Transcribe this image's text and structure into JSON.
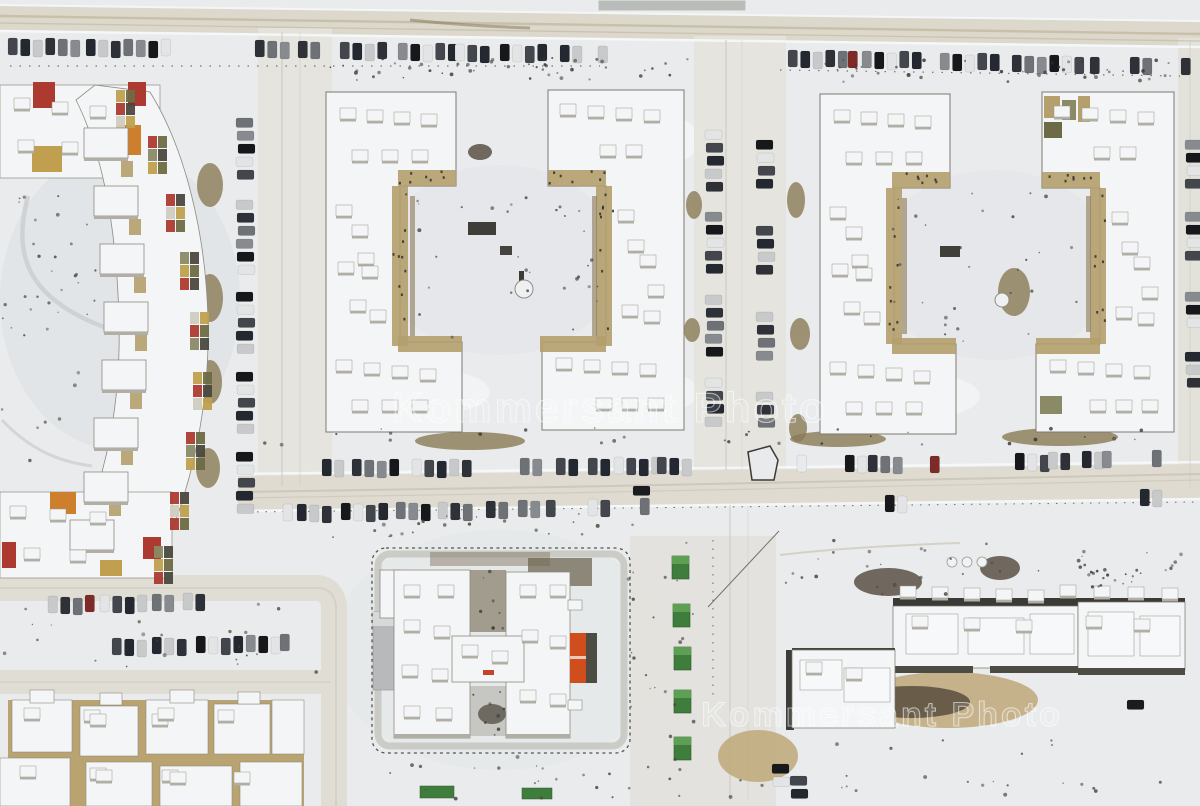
{
  "image": {
    "description": "Aerial winter drone photo of a snow-covered residential district: colorful zigzag apartment block on the left, four C-shaped apartment buildings around two courtyards, an H-shaped school under construction, a long building site at bottom right, parking rows full of cars along the streets",
    "width": 1200,
    "height": 806
  },
  "watermarks": {
    "center": "Kommersant Photo",
    "bottom": "Kommersant Photo"
  },
  "palette": {
    "snow": "#e9ebed",
    "snow_shadow": "#dde0e2",
    "snow_bright": "#f6f8f9",
    "road": "#dcd8cb",
    "road_light": "#e4e3dc",
    "road_track": "#b5a88c",
    "track_dark": "#77694c",
    "roof_white": "#f3f5f6",
    "roof_rim": "#8f8b81",
    "roof_shadow": "#b1aea6",
    "facade_tan": "#b49f6d",
    "facade_dark": "#4a483e",
    "accent_red": "#ad3a30",
    "accent_orange": "#cd7f2e",
    "accent_gold": "#c0a04e",
    "accent_olive": "#6d6b45",
    "cabin_green": "#3f7d3c",
    "cabin_green_light": "#61a455",
    "pitch_orange": "#d04d1d",
    "annex_gray": "#b7b9ba",
    "dirt_brown": "#8a7a55",
    "mud_dark": "#51473a",
    "sand_tan": "#bfa878",
    "car_colors": [
      "#16181b",
      "#2e3238",
      "#43474d",
      "#878b90",
      "#c7c9cb",
      "#e2e4e5",
      "#6e7277",
      "#242830"
    ],
    "car_red": "#7e2b28",
    "car_white": "#e8eaeb",
    "car_dark": "#1a1c1f"
  },
  "scene": {
    "parking_clusters": [
      [
        8,
        38,
        6,
        "v"
      ],
      [
        86,
        39,
        7,
        "v"
      ],
      [
        255,
        40,
        3,
        "v"
      ],
      [
        298,
        41,
        2,
        "v"
      ],
      [
        340,
        42,
        4,
        "v"
      ],
      [
        398,
        43,
        5,
        "v"
      ],
      [
        455,
        44,
        3,
        "v"
      ],
      [
        500,
        44,
        4,
        "v"
      ],
      [
        560,
        45,
        2,
        "v"
      ],
      [
        598,
        46,
        1,
        "v"
      ],
      [
        788,
        50,
        5,
        "v"
      ],
      [
        848,
        51,
        1,
        "v",
        "red"
      ],
      [
        862,
        51,
        5,
        "v"
      ],
      [
        940,
        53,
        5,
        "v"
      ],
      [
        1012,
        55,
        6,
        "v"
      ],
      [
        1090,
        57,
        1,
        "v"
      ],
      [
        1130,
        57,
        2,
        "v"
      ],
      [
        1181,
        58,
        1,
        "v"
      ],
      [
        236,
        118,
        5,
        "h"
      ],
      [
        236,
        200,
        6,
        "h"
      ],
      [
        236,
        292,
        5,
        "h"
      ],
      [
        236,
        372,
        5,
        "h"
      ],
      [
        236,
        452,
        5,
        "h"
      ],
      [
        705,
        130,
        5,
        "h"
      ],
      [
        705,
        212,
        5,
        "h"
      ],
      [
        705,
        295,
        5,
        "h"
      ],
      [
        705,
        378,
        4,
        "h"
      ],
      [
        756,
        140,
        4,
        "h"
      ],
      [
        756,
        226,
        4,
        "h"
      ],
      [
        756,
        312,
        4,
        "h"
      ],
      [
        756,
        392,
        3,
        "h"
      ],
      [
        1185,
        140,
        4,
        "h"
      ],
      [
        1185,
        212,
        4,
        "h"
      ],
      [
        1185,
        292,
        3,
        "h"
      ],
      [
        1185,
        352,
        3,
        "h"
      ],
      [
        322,
        459,
        2,
        "v"
      ],
      [
        352,
        459,
        4,
        "v"
      ],
      [
        412,
        459,
        5,
        "v"
      ],
      [
        520,
        458,
        2,
        "v"
      ],
      [
        556,
        458,
        2,
        "v"
      ],
      [
        588,
        458,
        2,
        "v"
      ],
      [
        614,
        457,
        4,
        "v"
      ],
      [
        657,
        457,
        3,
        "v"
      ],
      [
        797,
        455,
        1,
        "v",
        "white"
      ],
      [
        845,
        455,
        2,
        "v"
      ],
      [
        868,
        455,
        3,
        "v"
      ],
      [
        930,
        456,
        1,
        "v",
        "red"
      ],
      [
        1015,
        453,
        3,
        "v"
      ],
      [
        1048,
        452,
        2,
        "v"
      ],
      [
        1082,
        451,
        2,
        "v"
      ],
      [
        1102,
        451,
        1,
        "v"
      ],
      [
        1152,
        450,
        1,
        "v"
      ],
      [
        283,
        504,
        1,
        "v"
      ],
      [
        297,
        504,
        3,
        "v"
      ],
      [
        341,
        503,
        4,
        "v"
      ],
      [
        396,
        502,
        3,
        "v"
      ],
      [
        438,
        502,
        3,
        "v"
      ],
      [
        486,
        501,
        2,
        "v"
      ],
      [
        518,
        500,
        2,
        "v"
      ],
      [
        546,
        500,
        1,
        "v"
      ],
      [
        588,
        499,
        2,
        "v"
      ],
      [
        640,
        498,
        1,
        "v"
      ],
      [
        885,
        495,
        2,
        "v"
      ],
      [
        1140,
        489,
        2,
        "v"
      ],
      [
        633,
        486,
        1,
        "h",
        "dark"
      ],
      [
        48,
        596,
        3,
        "v"
      ],
      [
        85,
        595,
        1,
        "v",
        "red"
      ],
      [
        100,
        595,
        4,
        "v"
      ],
      [
        152,
        594,
        2,
        "v"
      ],
      [
        183,
        593,
        2,
        "v"
      ],
      [
        112,
        638,
        3,
        "v"
      ],
      [
        152,
        637,
        3,
        "v"
      ],
      [
        196,
        636,
        4,
        "v"
      ],
      [
        246,
        635,
        3,
        "v"
      ],
      [
        280,
        634,
        1,
        "v"
      ],
      [
        772,
        764,
        2,
        "h"
      ],
      [
        790,
        776,
        2,
        "h"
      ],
      [
        1127,
        700,
        1,
        "h",
        "dark"
      ]
    ],
    "roof_box_rows": [
      [
        340,
        108,
        4,
        27,
        2
      ],
      [
        352,
        150,
        3,
        30,
        0
      ],
      [
        336,
        205,
        1,
        0,
        0
      ],
      [
        352,
        225,
        2,
        6,
        28
      ],
      [
        338,
        262,
        2,
        24,
        4
      ],
      [
        350,
        300,
        2,
        20,
        10
      ],
      [
        336,
        360,
        4,
        28,
        3
      ],
      [
        352,
        400,
        3,
        30,
        0
      ],
      [
        560,
        104,
        4,
        28,
        2
      ],
      [
        600,
        145,
        2,
        26,
        0
      ],
      [
        618,
        210,
        2,
        10,
        30
      ],
      [
        640,
        255,
        2,
        8,
        30
      ],
      [
        622,
        305,
        2,
        22,
        6
      ],
      [
        556,
        358,
        4,
        28,
        2
      ],
      [
        596,
        398,
        3,
        26,
        0
      ],
      [
        834,
        110,
        4,
        27,
        2
      ],
      [
        846,
        152,
        3,
        30,
        0
      ],
      [
        830,
        207,
        1,
        0,
        0
      ],
      [
        846,
        227,
        2,
        6,
        28
      ],
      [
        832,
        264,
        2,
        24,
        4
      ],
      [
        844,
        302,
        2,
        20,
        10
      ],
      [
        830,
        362,
        4,
        28,
        3
      ],
      [
        846,
        402,
        3,
        30,
        0
      ],
      [
        1054,
        106,
        4,
        28,
        2
      ],
      [
        1094,
        147,
        2,
        26,
        0
      ],
      [
        1112,
        212,
        2,
        10,
        30
      ],
      [
        1134,
        257,
        2,
        8,
        30
      ],
      [
        1116,
        307,
        2,
        22,
        6
      ],
      [
        1050,
        360,
        4,
        28,
        2
      ],
      [
        1090,
        400,
        3,
        26,
        0
      ],
      [
        404,
        585,
        2,
        34,
        0
      ],
      [
        404,
        620,
        2,
        30,
        6
      ],
      [
        402,
        665,
        2,
        30,
        4
      ],
      [
        404,
        706,
        2,
        32,
        2
      ],
      [
        520,
        585,
        2,
        30,
        0
      ],
      [
        522,
        630,
        2,
        28,
        6
      ],
      [
        520,
        690,
        2,
        30,
        4
      ],
      [
        462,
        645,
        2,
        30,
        6
      ],
      [
        912,
        616,
        3,
        52,
        2
      ],
      [
        1086,
        616,
        2,
        48,
        3
      ],
      [
        806,
        662,
        2,
        40,
        6
      ],
      [
        900,
        586,
        5,
        32,
        1
      ],
      [
        1060,
        585,
        4,
        34,
        1
      ],
      [
        24,
        708,
        2,
        60,
        2
      ],
      [
        90,
        714,
        2,
        62,
        0
      ],
      [
        158,
        708,
        2,
        60,
        2
      ],
      [
        20,
        766,
        2,
        70,
        2
      ],
      [
        96,
        770,
        2,
        66,
        0
      ],
      [
        170,
        772,
        2,
        64,
        0
      ],
      [
        14,
        98,
        3,
        38,
        4
      ],
      [
        18,
        140,
        2,
        44,
        2
      ],
      [
        10,
        506,
        3,
        40,
        3
      ],
      [
        24,
        548,
        2,
        46,
        2
      ]
    ],
    "mosaic_path": [
      [
        120,
        96
      ],
      [
        152,
        142
      ],
      [
        170,
        200
      ],
      [
        184,
        258
      ],
      [
        194,
        318
      ],
      [
        197,
        378
      ],
      [
        190,
        438
      ],
      [
        174,
        498
      ],
      [
        158,
        552
      ]
    ],
    "step_boxes": [
      [
        84,
        128
      ],
      [
        94,
        186
      ],
      [
        100,
        244
      ],
      [
        104,
        302
      ],
      [
        102,
        360
      ],
      [
        94,
        418
      ],
      [
        84,
        472
      ],
      [
        70,
        520
      ]
    ],
    "green_cabins": [
      [
        672,
        556
      ],
      [
        673,
        604
      ],
      [
        674,
        647
      ],
      [
        674,
        690
      ],
      [
        674,
        737
      ]
    ],
    "green_cabins_small": [
      [
        420,
        786,
        34,
        12
      ],
      [
        522,
        788,
        30,
        11
      ]
    ],
    "dirt_patches": [
      [
        470,
        441,
        55,
        9,
        "dirt"
      ],
      [
        838,
        439,
        48,
        8,
        "dirt"
      ],
      [
        1060,
        437,
        58,
        9,
        "dirt"
      ],
      [
        210,
        185,
        13,
        22,
        "dirt"
      ],
      [
        210,
        298,
        13,
        24,
        "dirt"
      ],
      [
        210,
        382,
        12,
        22,
        "dirt"
      ],
      [
        208,
        468,
        12,
        20,
        "dirt"
      ],
      [
        796,
        200,
        9,
        18,
        "dirt"
      ],
      [
        800,
        334,
        10,
        16,
        "dirt"
      ],
      [
        798,
        428,
        9,
        14,
        "dirt"
      ],
      [
        694,
        205,
        8,
        14,
        "dirt"
      ],
      [
        692,
        330,
        8,
        12,
        "dirt"
      ],
      [
        1014,
        292,
        16,
        24,
        "dirt"
      ],
      [
        948,
        700,
        90,
        28,
        "sand"
      ],
      [
        758,
        756,
        40,
        26,
        "sand"
      ],
      [
        888,
        582,
        34,
        14,
        "mud"
      ],
      [
        1000,
        568,
        20,
        12,
        "mud"
      ],
      [
        912,
        702,
        58,
        16,
        "mud"
      ],
      [
        480,
        152,
        12,
        8,
        "mud"
      ],
      [
        360,
        128,
        10,
        6,
        "mud"
      ]
    ]
  }
}
